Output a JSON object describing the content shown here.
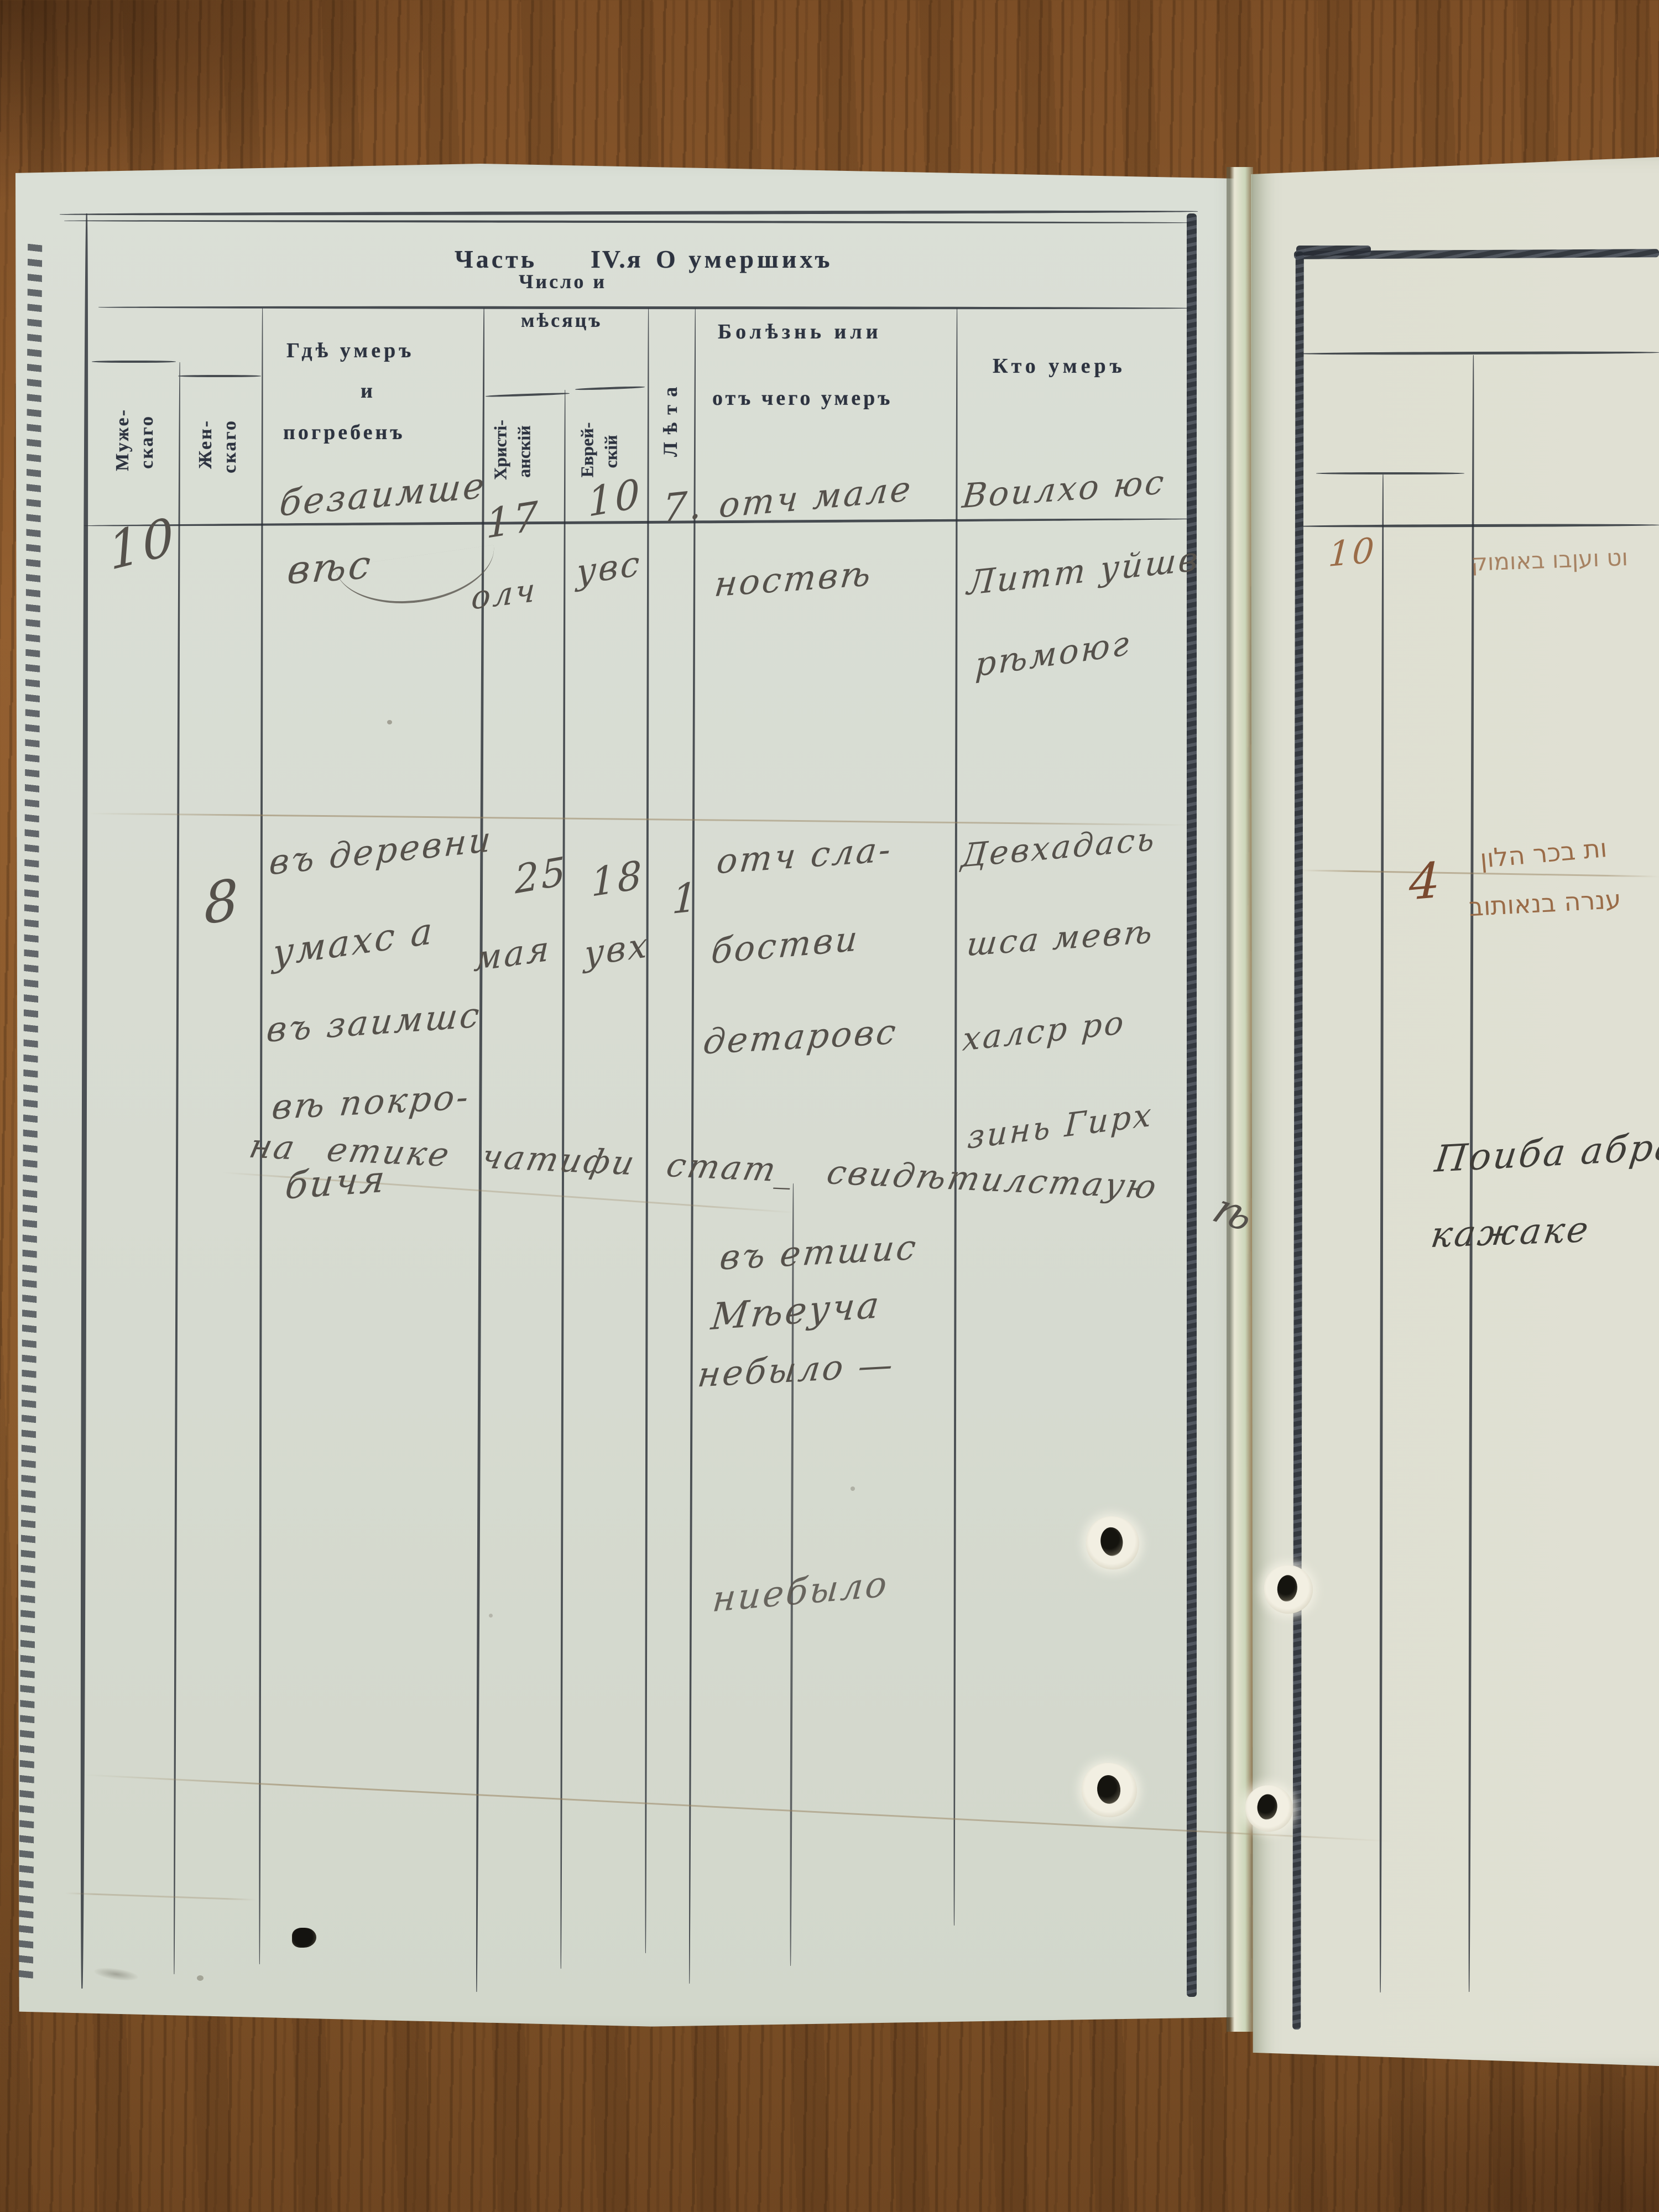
{
  "document": {
    "title": {
      "part1": "Часть",
      "part2": "IV.я",
      "part3": "О умершихъ"
    },
    "columns": {
      "male": {
        "l1": "Муже-",
        "l2": "скаго"
      },
      "female": {
        "l1": "Жен-",
        "l2": "скаго"
      },
      "where": {
        "l1": "Гдѣ  умеръ",
        "l2": "и",
        "l3": "погребенъ"
      },
      "date_group": {
        "l1": "Число и",
        "l2": "мѣсяцъ"
      },
      "christian": {
        "l1": "Христі-",
        "l2": "анскій"
      },
      "jewish": {
        "l1": "Еврей-",
        "l2": "скій"
      },
      "age": "Лѣта",
      "disease": {
        "l1": "Болѣзнь  или",
        "l2": "отъ  чего  умеръ"
      },
      "who": "Кто  умеръ"
    }
  },
  "entries": [
    {
      "male_count": "10",
      "where_l1": "безаимше",
      "where_l2": "вѣс",
      "christian_day": "17",
      "christian_month": "олч",
      "jewish_day": "10",
      "jewish_month": "увс",
      "age": "7.",
      "disease_l1": "отч мале",
      "disease_l2": "ноствѣ",
      "who_l1": "Воилхо юс",
      "who_l2": "Литт уйшв",
      "who_l3": "рѣмоюг"
    },
    {
      "female_count": "8",
      "where_l1": "въ деревни",
      "where_l2": "умахс а",
      "where_l3": "въ заимшс",
      "where_l4": "вѣ покро-",
      "where_l5": "бичя",
      "christian_day": "25",
      "christian_month": "мая",
      "jewish_day": "18",
      "jewish_month": "увх",
      "age": "1",
      "disease_l1": "отч сла-",
      "disease_l2": "бостви",
      "disease_l3": "детаровс",
      "who_l1": "Девхадась",
      "who_l2": "шса мевѣ",
      "who_l3": "халср ро",
      "who_l4": "зинь Гирх"
    }
  ],
  "annotations": {
    "diagonal_note": "на етике чатифи стат_  свидѣтилстаую",
    "diagonal_tail": "ѣ",
    "no_month_l1": "въ етшис",
    "no_month_l2": "Мѣеуча",
    "no_month_l3": "небыло —",
    "faded_note": "ниебыло"
  },
  "right_page": {
    "row1_number": "10",
    "row1_hebrew": "וט ועןבו באומוק",
    "row2_number": "4",
    "row2_hebrew_l1": "ות בכר הלון",
    "row2_hebrew_l2": "ענרה בנאותוב",
    "note_l1": "Поиба абра",
    "note_l2": "кажаке"
  },
  "colors": {
    "wood": "#96662f",
    "paper_left": "#d8dcd2",
    "paper_right": "#deded2",
    "print_ink": "#2d3340",
    "hand_ink": "#55514b",
    "sepia_ink": "#9a6c48",
    "line_ink": "#2c3138"
  }
}
